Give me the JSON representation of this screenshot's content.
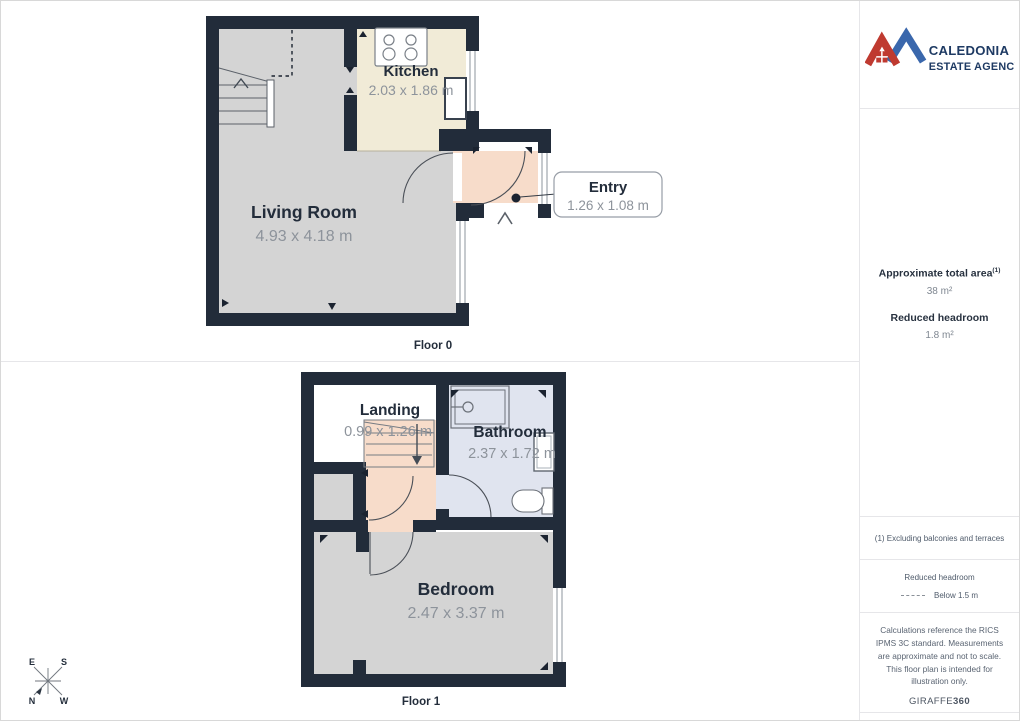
{
  "logo": {
    "line1": "CALEDONIA",
    "line2": "ESTATE AGENCY"
  },
  "sidebar": {
    "total_area_label": "Approximate total area",
    "total_area_footnote_marker": "(1)",
    "total_area_value": "38 m²",
    "reduced_headroom_label": "Reduced headroom",
    "reduced_headroom_value": "1.8 m²",
    "footnote": "(1) Excluding balconies and terraces",
    "legend_title": "Reduced headroom",
    "legend_item": "Below 1.5 m",
    "disclaimer": "Calculations reference the RICS IPMS 3C standard. Measurements are approximate and not to scale. This floor plan is intended for illustration only.",
    "brand_name": "GIRAFFE",
    "brand_suffix": "360"
  },
  "floor0": {
    "label": "Floor 0",
    "rooms": {
      "kitchen": {
        "name": "Kitchen",
        "dims": "2.03 x 1.86 m",
        "color": "#f1ebd7"
      },
      "living_room": {
        "name": "Living Room",
        "dims": "4.93 x 4.18 m",
        "color": "#d4d4d4"
      },
      "entry": {
        "name": "Entry",
        "dims": "1.26 x 1.08 m",
        "color": "#f7dcca"
      }
    }
  },
  "floor1": {
    "label": "Floor 1",
    "rooms": {
      "landing": {
        "name": "Landing",
        "dims": "0.99 x 1.26 m",
        "color": "#ffffff"
      },
      "bathroom": {
        "name": "Bathroom",
        "dims": "2.37 x 1.72 m",
        "color": "#e0e4ef"
      },
      "bedroom": {
        "name": "Bedroom",
        "dims": "2.47 x 3.37 m",
        "color": "#d4d4d4"
      }
    }
  },
  "compass": {
    "n": "N",
    "s": "S",
    "e": "E",
    "w": "W"
  },
  "colors": {
    "wall": "#222c3a",
    "reduced_headroom_fill": "#f7dcca",
    "logo_red": "#bf3a30",
    "logo_blue": "#3a67ac",
    "logo_text": "#1e3a63",
    "title_text": "#232d3b",
    "dim_text": "#8d939b"
  }
}
